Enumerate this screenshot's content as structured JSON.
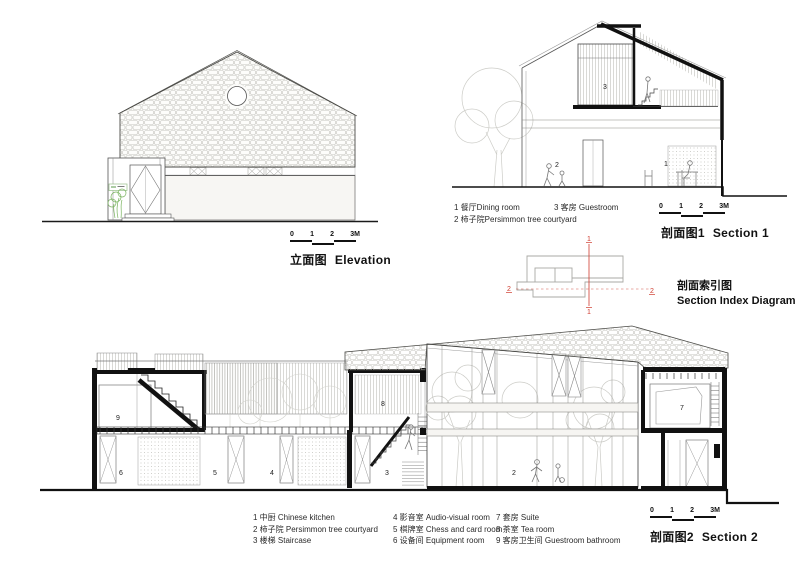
{
  "colors": {
    "red": "#cf3b2e",
    "green": "#79b35e",
    "ink": "#1a1a1a"
  },
  "scalebar": {
    "n0": "0",
    "n1": "1",
    "n2": "2",
    "n3": "3M"
  },
  "elevation": {
    "title_zh": "立面图",
    "title_en": "Elevation"
  },
  "section1": {
    "title_zh": "剖面图1",
    "title_en": "Section 1",
    "legend": [
      "1 餐厅Dining room",
      "2 柿子院Persimmon tree courtyard",
      "3 客房 Guestroom"
    ],
    "rooms": {
      "dining": "1",
      "courtyard": "2",
      "guestroom": "3"
    }
  },
  "section_index": {
    "title_zh": "剖面索引图",
    "title_en": "Section Index Diagram",
    "mark1": "1",
    "mark2": "2"
  },
  "section2": {
    "title_zh": "剖面图2",
    "title_en": "Section 2",
    "legend_col1": [
      "1 中厨 Chinese kitchen",
      "2 柿子院 Persimmon tree courtyard",
      "3 楼梯 Staircase"
    ],
    "legend_col2": [
      "4 影音室 Audio-visual room",
      "5 棋牌室 Chess and card room",
      "6 设备间 Equipment room"
    ],
    "legend_col3": [
      "7 套房 Suite",
      "8 茶室 Tea room",
      "9 客房卫生间 Guestroom bathroom"
    ],
    "rooms": {
      "courtyard": "2",
      "staircase": "3",
      "av": "4",
      "chess": "5",
      "equip": "6",
      "suite": "7",
      "tea": "8",
      "bath": "9"
    }
  }
}
